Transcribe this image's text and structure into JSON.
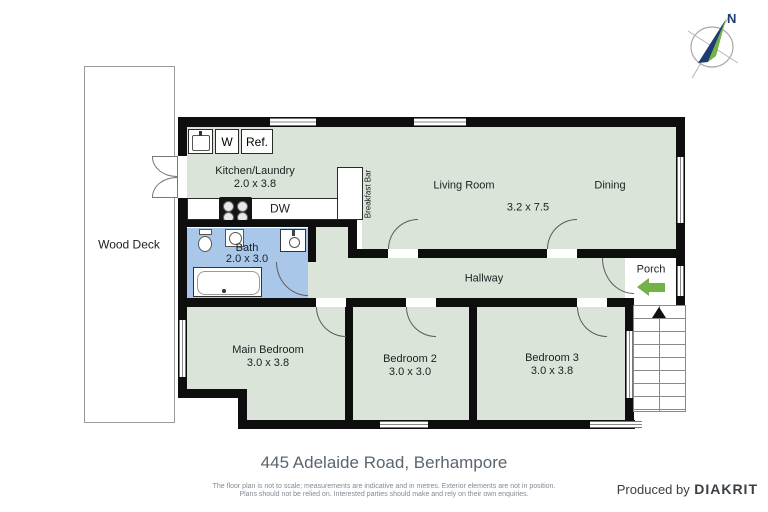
{
  "compass": {
    "north": "N"
  },
  "rooms": {
    "wood_deck": {
      "label": "Wood Deck"
    },
    "kitchen": {
      "label": "Kitchen/Laundry",
      "dims": "2.0 x 3.8"
    },
    "living": {
      "label": "Living Room",
      "dims": "3.2 x 7.5"
    },
    "dining": {
      "label": "Dining"
    },
    "breakfast_bar": {
      "label": "Breakfast Bar"
    },
    "bath": {
      "label": "Bath",
      "dims": "2.0 x 3.0"
    },
    "hallway": {
      "label": "Hallway"
    },
    "main_bedroom": {
      "label": "Main Bedroom",
      "dims": "3.0 x 3.8"
    },
    "bedroom2": {
      "label": "Bedroom 2",
      "dims": "3.0 x 3.0"
    },
    "bedroom3": {
      "label": "Bedroom 3",
      "dims": "3.0 x 3.8"
    },
    "porch": {
      "label": "Porch"
    }
  },
  "appliances": {
    "washer": "W",
    "fridge": "Ref.",
    "dishwasher": "DW"
  },
  "footer": {
    "address": "445 Adelaide Road, Berhampore",
    "disclaimer1": "The floor plan is not to scale; measurements are indicative and in metres. Exterior elements are not in position.",
    "disclaimer2": "Plans should not be relied on. Interested parties should make and rely on their own enquiries.",
    "credit_prefix": "Produced by",
    "credit_brand": "DIAKRIT"
  },
  "colors": {
    "wall": "#0e0e0e",
    "room-green": "#dbe4d8",
    "bath-blue": "#a9c7e8",
    "arrow-green": "#74b247",
    "compass-navy": "#1d3d6e",
    "compass-green": "#74b247",
    "address-c": "#5a6570",
    "disclaimer-c": "#808b96",
    "credit-c": "#3a3f44"
  }
}
